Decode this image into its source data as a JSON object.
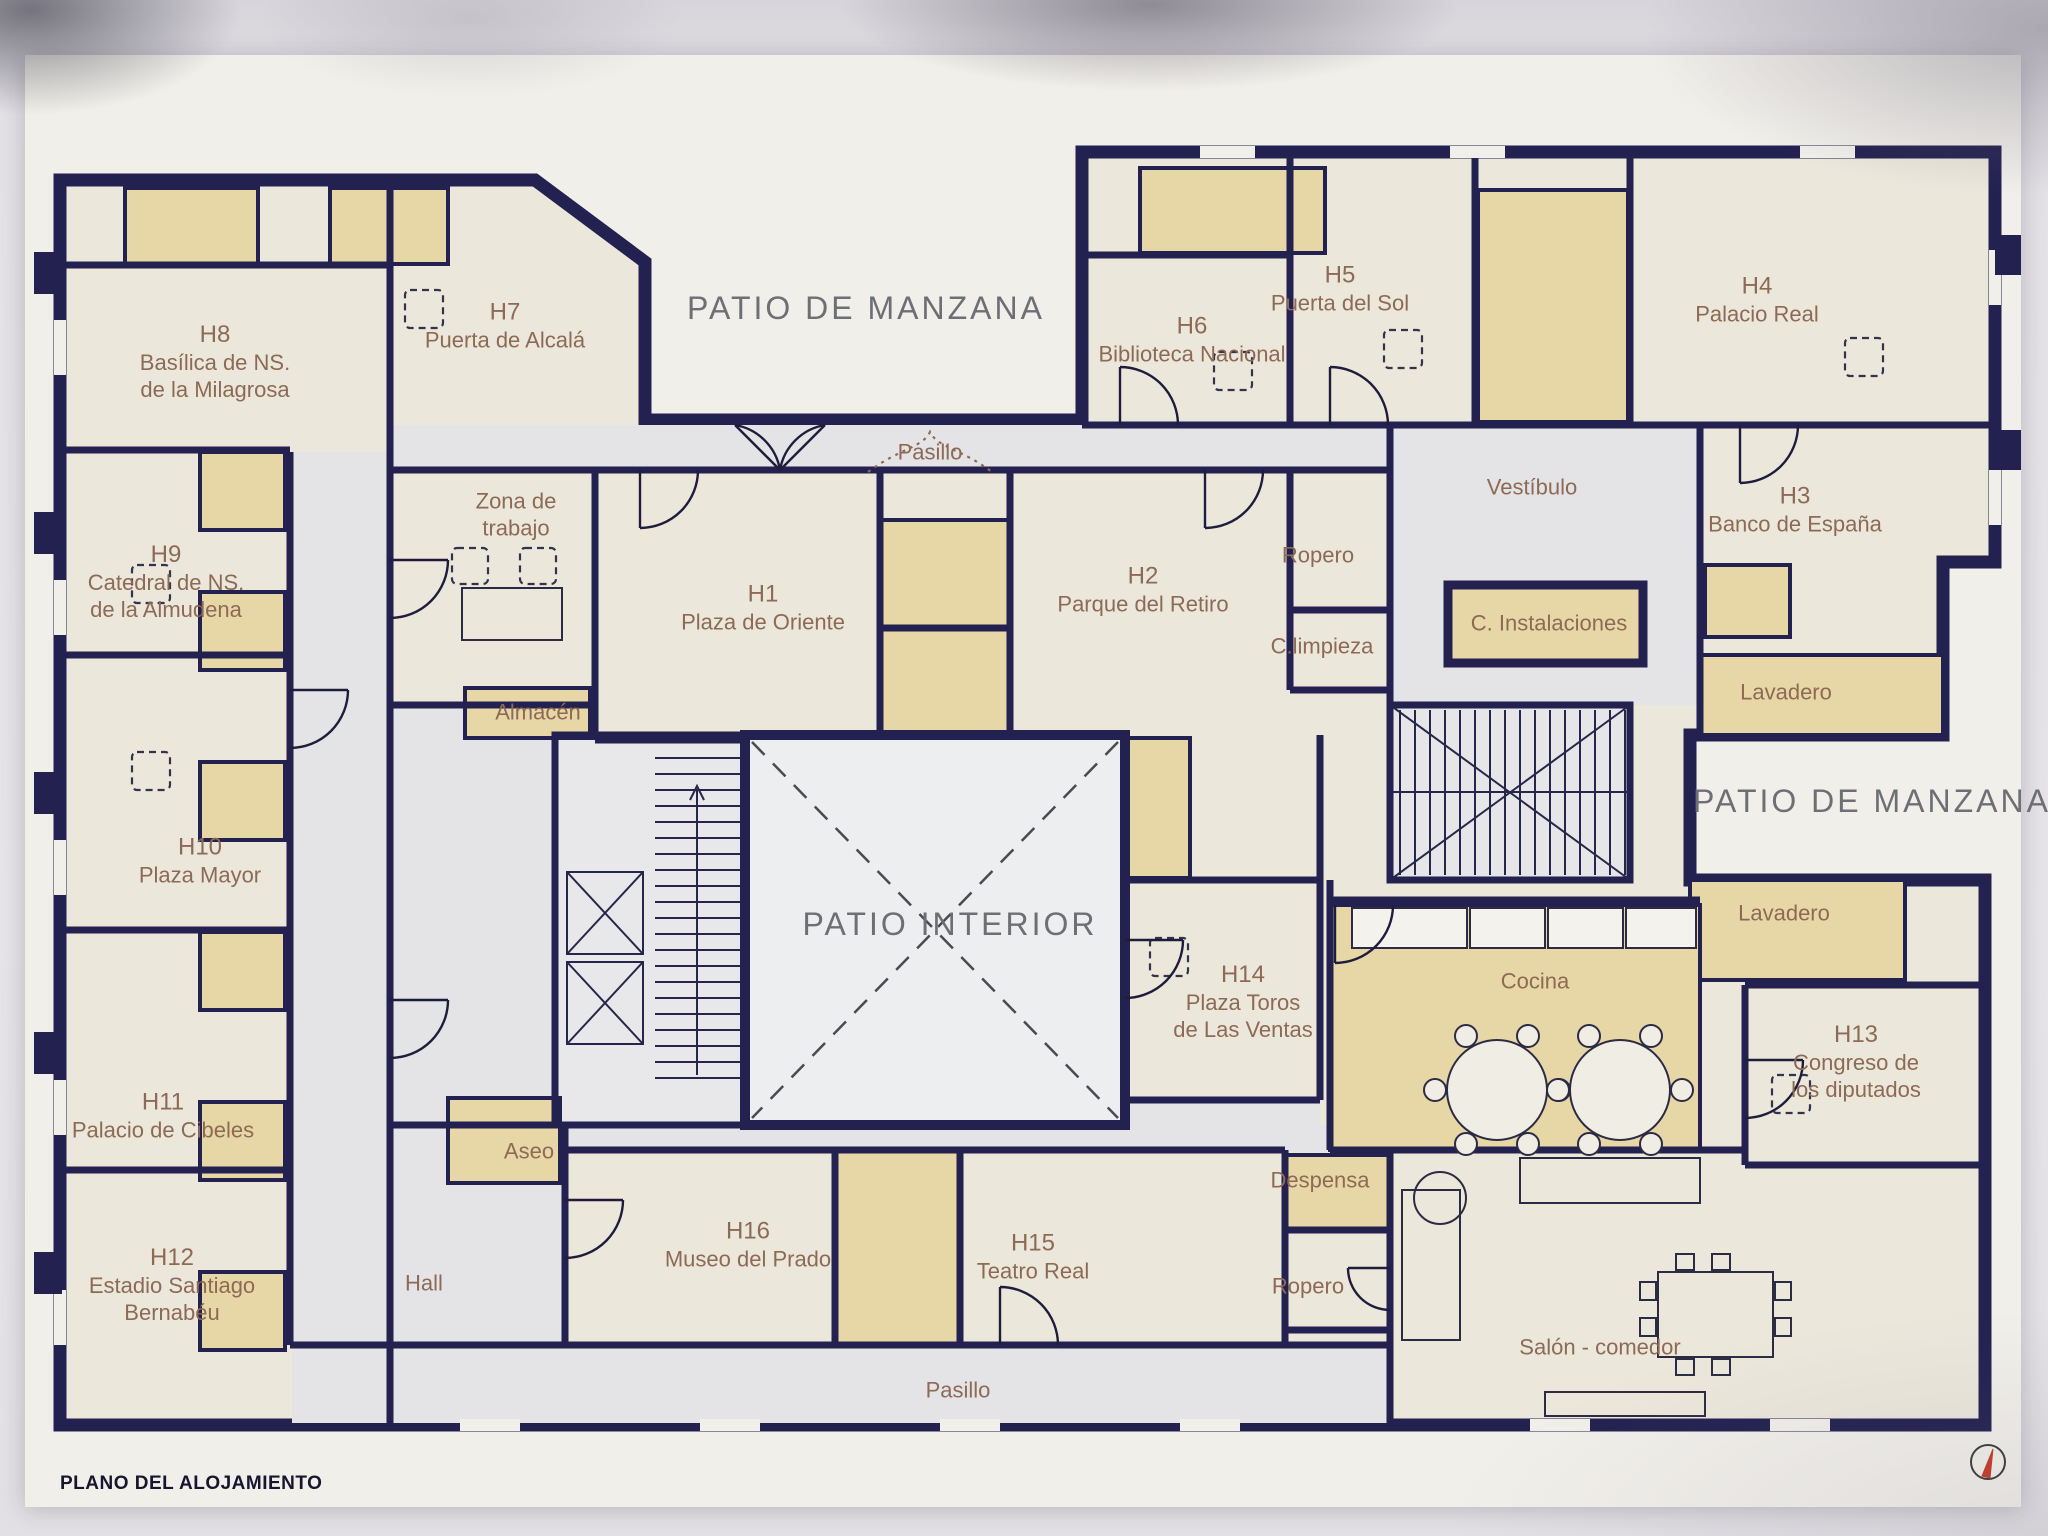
{
  "meta": {
    "plan_title": "PLANO DEL ALOJAMIENTO"
  },
  "areas": {
    "patio_manzana_top": "PATIO DE MANZANA",
    "patio_manzana_right": "PATIO DE  MANZANA",
    "patio_interior": "PATIO INTERIOR",
    "pasillo_top": "Pasillo",
    "pasillo_bottom": "Pasillo",
    "vestibulo": "Vestíbulo",
    "hall": "Hall",
    "zona_trabajo": [
      "Zona de",
      "trabajo"
    ],
    "almacen": "Almacén",
    "aseo": "Aseo",
    "ropero_top": "Ropero",
    "ropero_bottom": "Ropero",
    "c_limpieza": "C.limpieza",
    "c_instalaciones": "C. Instalaciones",
    "lavadero_top": "Lavadero",
    "lavadero_right": "Lavadero",
    "cocina": "Cocina",
    "despensa": "Despensa",
    "salon_comedor": "Salón - comedor"
  },
  "rooms": {
    "h1": {
      "code": "H1",
      "lines": [
        "Plaza de Oriente"
      ]
    },
    "h2": {
      "code": "H2",
      "lines": [
        "Parque del Retiro"
      ]
    },
    "h3": {
      "code": "H3",
      "lines": [
        "Banco de España"
      ]
    },
    "h4": {
      "code": "H4",
      "lines": [
        "Palacio Real"
      ]
    },
    "h5": {
      "code": "H5",
      "lines": [
        "Puerta del Sol"
      ]
    },
    "h6": {
      "code": "H6",
      "lines": [
        "Biblioteca Nacional"
      ]
    },
    "h7": {
      "code": "H7",
      "lines": [
        "Puerta de Alcalá"
      ]
    },
    "h8": {
      "code": "H8",
      "lines": [
        "Basílica de NS.",
        "de la Milagrosa"
      ]
    },
    "h9": {
      "code": "H9",
      "lines": [
        "Catedral de NS.",
        "de la Almudena"
      ]
    },
    "h10": {
      "code": "H10",
      "lines": [
        "Plaza Mayor"
      ]
    },
    "h11": {
      "code": "H11",
      "lines": [
        "Palacio de Cibeles"
      ]
    },
    "h12": {
      "code": "H12",
      "lines": [
        "Estadio Santiago",
        "Bernabéu"
      ]
    },
    "h13": {
      "code": "H13",
      "lines": [
        "Congreso de",
        "los diputados"
      ]
    },
    "h14": {
      "code": "H14",
      "lines": [
        "Plaza Toros",
        "de Las Ventas"
      ]
    },
    "h15": {
      "code": "H15",
      "lines": [
        "Teatro Real"
      ]
    },
    "h16": {
      "code": "H16",
      "lines": [
        "Museo del Prado"
      ]
    }
  },
  "colors": {
    "wall": "#232150",
    "wet_room": "#e8d7a6",
    "room": "#ebe7db",
    "corridor": "#e4e3e6",
    "room_label": "#8d6a55",
    "patio_label": "#6e6f74",
    "compass_needle": "#c23b2a"
  }
}
